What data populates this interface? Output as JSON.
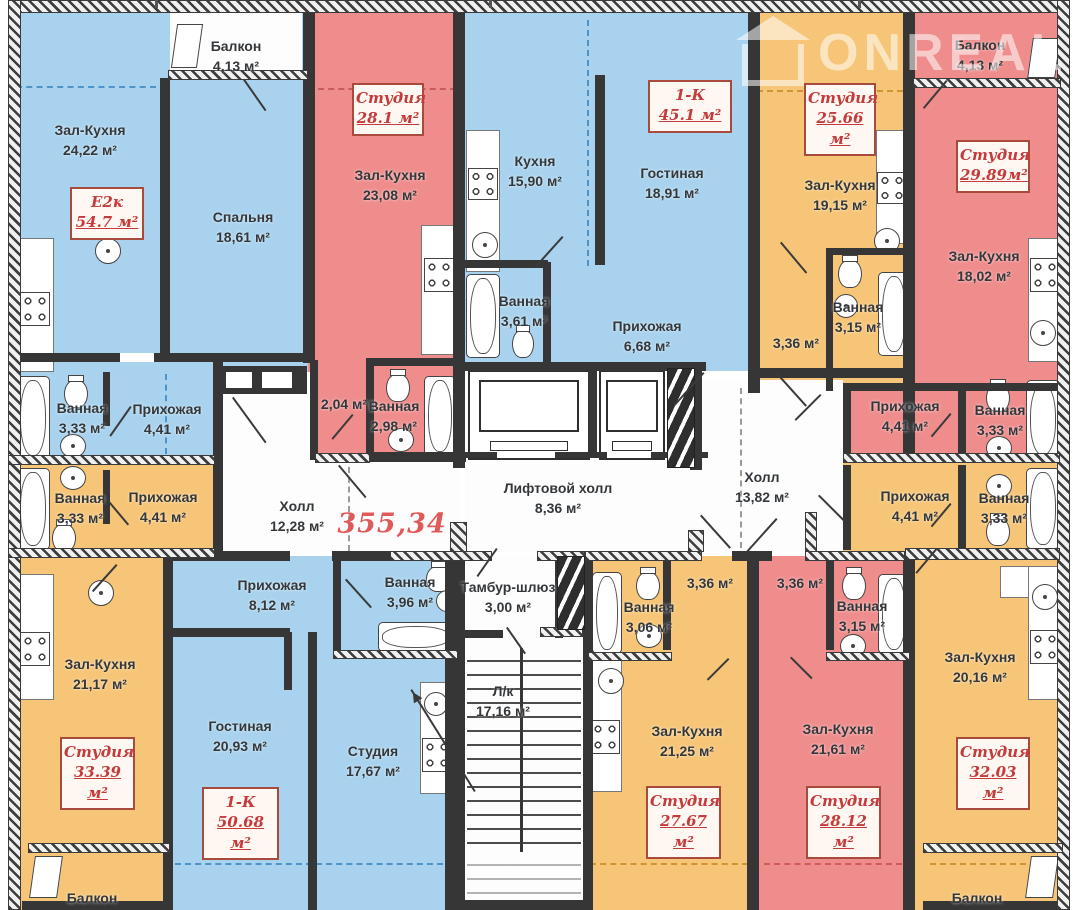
{
  "plan": {
    "title": "Поэтажный план секции",
    "total_area": "355,34",
    "watermark": "ONREAL",
    "units": "м²"
  },
  "colors": {
    "apartment_blue": "#a8d2ee",
    "apartment_red": "#ef8c8c",
    "apartment_orange": "#f6c577",
    "wall": "#363636",
    "unit_label_red": "#c43b3b",
    "total_area_red": "#e05a5a"
  },
  "icons": {
    "bathtub-icon": "rounded rectangle with inner rim",
    "toilet-icon": "oval bowl with tank",
    "sink-icon": "circle with center dot",
    "stove-icon": "square with four burner rings",
    "elevator-icon": "rectangle with inner cab",
    "stairs-icon": "parallel treads with up arrow",
    "door-swing-icon": "diagonal leaf line",
    "window-icon": "skewed white pane",
    "house-icon": "watermark house outline"
  },
  "unit_boxes": [
    {
      "type": "Е2к",
      "area": "54.7 м²"
    },
    {
      "type": "Студия",
      "area": "28.1 м²"
    },
    {
      "type": "1-К",
      "area": "45.1 м²"
    },
    {
      "type": "Студия",
      "area": "25.66 м²"
    },
    {
      "type": "Студия",
      "area": "29.89м²"
    },
    {
      "type": "Студия",
      "area": "33.39 м²"
    },
    {
      "type": "1-К",
      "area": "50.68 м²"
    },
    {
      "type": "Студия",
      "area": "27.67 м²"
    },
    {
      "type": "Студия",
      "area": "28.12 м²"
    },
    {
      "type": "Студия",
      "area": "32.03 м²"
    }
  ],
  "rooms": [
    {
      "name": "Балкон",
      "area": "4,13 м²"
    },
    {
      "name": "Зал-Кухня",
      "area": "24,22 м²"
    },
    {
      "name": "Спальня",
      "area": "18,61 м²"
    },
    {
      "name": "Ванная",
      "area": "3,33 м²"
    },
    {
      "name": "Прихожая",
      "area": "4,41 м²"
    },
    {
      "name": "Зал-Кухня",
      "area": "23,08 м²"
    },
    {
      "name": "",
      "area": "2,04 м²"
    },
    {
      "name": "Ванная",
      "area": "2,98 м²"
    },
    {
      "name": "Кухня",
      "area": "15,90 м²"
    },
    {
      "name": "Гостиная",
      "area": "18,91 м²"
    },
    {
      "name": "Ванная",
      "area": "3,61 м²"
    },
    {
      "name": "Прихожая",
      "area": "6,68 м²"
    },
    {
      "name": "Зал-Кухня",
      "area": "19,15 м²"
    },
    {
      "name": "",
      "area": "3,36 м²"
    },
    {
      "name": "Ванная",
      "area": "3,15 м²"
    },
    {
      "name": "Балкон",
      "area": "4,13 м²"
    },
    {
      "name": "Зал-Кухня",
      "area": "18,02 м²"
    },
    {
      "name": "Прихожая",
      "area": "4,41 м²"
    },
    {
      "name": "Ванная",
      "area": "3,33 м²"
    },
    {
      "name": "Холл",
      "area": "12,28 м²"
    },
    {
      "name": "Лифтовой холл",
      "area": "8,36 м²"
    },
    {
      "name": "Холл",
      "area": "13,82 м²"
    },
    {
      "name": "Тамбур-шлюз",
      "area": "3,00 м²"
    },
    {
      "name": "Л/к",
      "area": "17,16 м²"
    },
    {
      "name": "Ванная",
      "area": "3,33 м²"
    },
    {
      "name": "Прихожая",
      "area": "4,41 м²"
    },
    {
      "name": "Зал-Кухня",
      "area": "21,17 м²"
    },
    {
      "name": "Балкон",
      "area": ""
    },
    {
      "name": "Прихожая",
      "area": "8,12 м²"
    },
    {
      "name": "Гостиная",
      "area": "20,93 м²"
    },
    {
      "name": "Ванная",
      "area": "3,96 м²"
    },
    {
      "name": "Студия",
      "area": "17,67 м²"
    },
    {
      "name": "",
      "area": "3,36 м²"
    },
    {
      "name": "Ванная",
      "area": "3,06 м²"
    },
    {
      "name": "Зал-Кухня",
      "area": "21,25 м²"
    },
    {
      "name": "",
      "area": "3,36 м²"
    },
    {
      "name": "Ванная",
      "area": "3,15 м²"
    },
    {
      "name": "Зал-Кухня",
      "area": "21,61 м²"
    },
    {
      "name": "Прихожая",
      "area": "4,41 м²"
    },
    {
      "name": "Ванная",
      "area": "3,33 м²"
    },
    {
      "name": "Зал-Кухня",
      "area": "20,16 м²"
    },
    {
      "name": "Балкон",
      "area": ""
    }
  ]
}
